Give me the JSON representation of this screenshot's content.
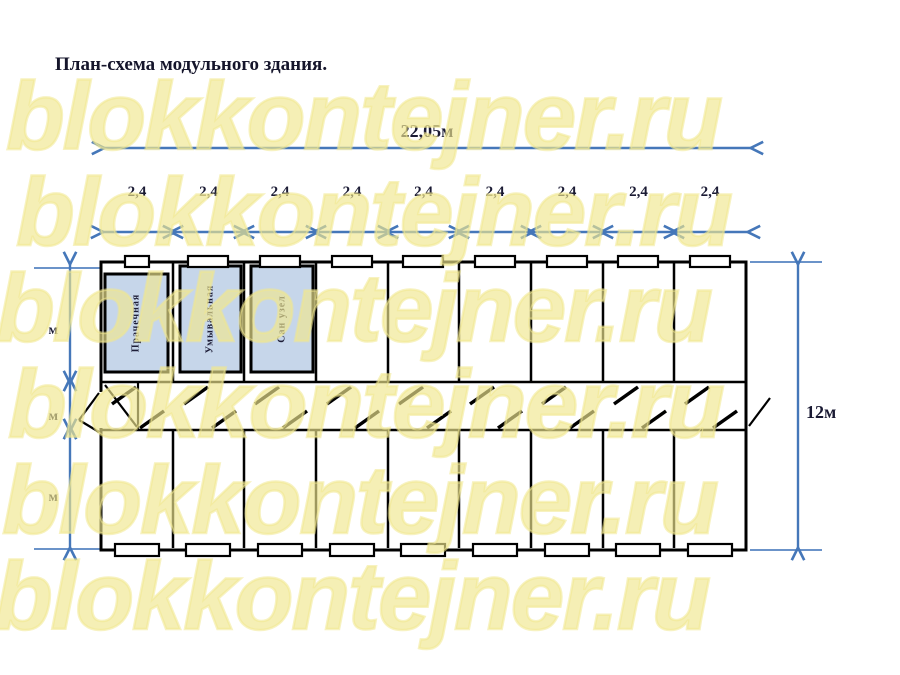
{
  "title": "План-схема модульного здания.",
  "watermark": {
    "text": "blokkontejner.ru",
    "color": "#f0e78e"
  },
  "plan": {
    "total_width_label": "22,05м",
    "module_width_labels": [
      "2,4",
      "2,4",
      "2,4",
      "2,4",
      "2,4",
      "2,4",
      "2,4",
      "2,4",
      "2,4"
    ],
    "height_label": "12м",
    "left_dim_labels": [
      "м",
      "м",
      "м"
    ],
    "modules_per_row": 9,
    "rooms": [
      {
        "label": "Прачечная"
      },
      {
        "label": "Умывальная"
      },
      {
        "label": "Сан узел"
      }
    ],
    "colors": {
      "dimension_blue": "#4577b9",
      "wall_black": "#000000",
      "room_fill": "#c6d6ea"
    }
  }
}
